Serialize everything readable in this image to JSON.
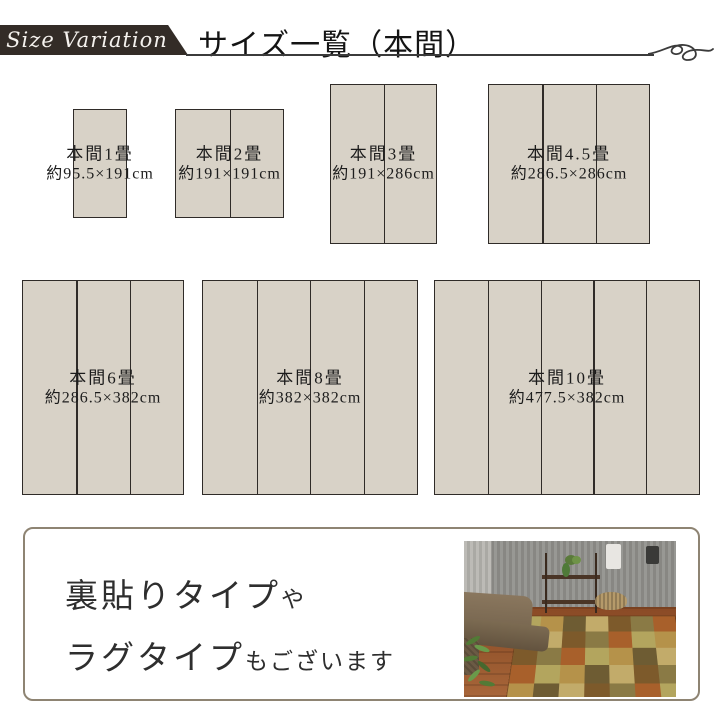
{
  "header": {
    "badge_label": "Size Variation",
    "title": "サイズ一覧（本間）"
  },
  "sizes": [
    {
      "id": "honma-1jo",
      "label": "本間1畳",
      "dims": "約95.5×191cm",
      "panels": 1
    },
    {
      "id": "honma-2jo",
      "label": "本間2畳",
      "dims": "約191×191cm",
      "panels": 2
    },
    {
      "id": "honma-3jo",
      "label": "本間3畳",
      "dims": "約191×286cm",
      "panels": 2
    },
    {
      "id": "honma-4-5jo",
      "label": "本間4.5畳",
      "dims": "約286.5×286cm",
      "panels": 3
    },
    {
      "id": "honma-6jo",
      "label": "本間6畳",
      "dims": "約286.5×382cm",
      "panels": 3
    },
    {
      "id": "honma-8jo",
      "label": "本間8畳",
      "dims": "約382×382cm",
      "panels": 4
    },
    {
      "id": "honma-10jo",
      "label": "本間10畳",
      "dims": "約477.5×382cm",
      "panels": 5
    }
  ],
  "footer_note": {
    "line1_main": "裏貼りタイプ",
    "line1_small": "や",
    "line2_main": "ラグタイプ",
    "line2_small": "もございます"
  },
  "photo": {
    "description": "living room with sofa, shelf and patchwork tatami rug",
    "rug_palette": [
      "#b3a55e",
      "#c2ab6a",
      "#a8602b",
      "#6e5c33",
      "#8a7a45",
      "#b5924a",
      "#7d5a2b"
    ]
  },
  "colors": {
    "mat_fill": "#d8d2c7",
    "mat_border": "#2f2b28",
    "badge_bg": "#332c27",
    "rule": "#3b3b3b",
    "note_box_border": "#8e8473",
    "text": "#1f1f1f"
  }
}
